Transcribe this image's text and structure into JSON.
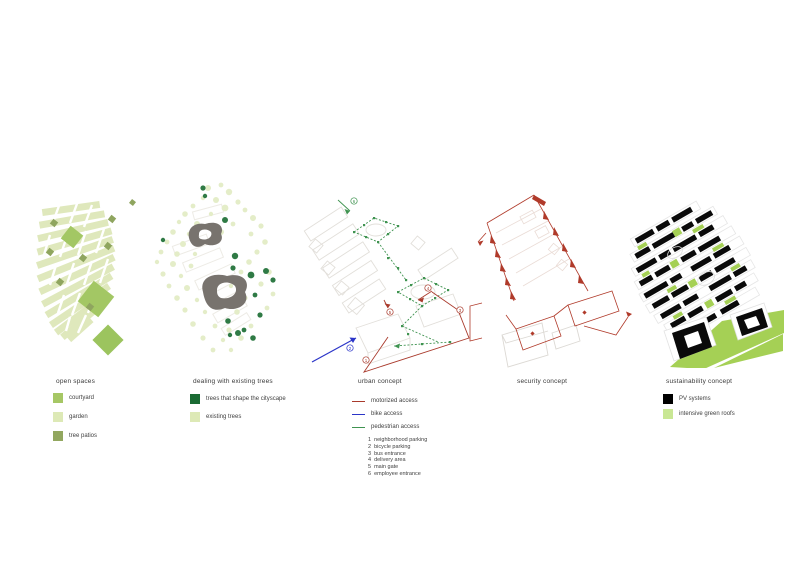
{
  "sheet": {
    "background": "#ffffff"
  },
  "colors": {
    "pale_green": "#dde9b6",
    "courtyard_green": "#a6c765",
    "tree_patio_olive": "#92a75f",
    "dark_tree_green": "#1a6b33",
    "motorized_red": "#a93a2c",
    "bike_blue": "#2b35c8",
    "pedestrian_green": "#3f9350",
    "pv_black": "#000000",
    "green_roof": "#c9e794",
    "vivid_roof_green": "#a5d055",
    "blob_grey": "#78736e"
  },
  "panels": [
    {
      "id": "open-spaces",
      "title": "open spaces",
      "legend": [
        {
          "label": "courtyard",
          "color": "#a6c765"
        },
        {
          "label": "garden",
          "color": "#dde9b6"
        },
        {
          "label": "tree patios",
          "color": "#92a75f"
        }
      ]
    },
    {
      "id": "existing-trees",
      "title": "dealing with existing trees",
      "legend": [
        {
          "label": "trees that shape the cityscape",
          "color": "#1a6b33"
        },
        {
          "label": "existing trees",
          "color": "#dde9b6"
        }
      ]
    },
    {
      "id": "urban-concept",
      "title": "urban concept",
      "legend_lines": [
        {
          "label": "motorized access",
          "color": "#a93a2c"
        },
        {
          "label": "bike access",
          "color": "#2b35c8"
        },
        {
          "label": "pedestrian access",
          "color": "#3f9350"
        }
      ],
      "numbered_items": [
        {
          "num": "1",
          "label": "neighborhood parking"
        },
        {
          "num": "2",
          "label": "bicycle parking"
        },
        {
          "num": "3",
          "label": "bus entrance"
        },
        {
          "num": "4",
          "label": "delivery area"
        },
        {
          "num": "5",
          "label": "main gate"
        },
        {
          "num": "6",
          "label": "employee entrance"
        }
      ]
    },
    {
      "id": "security-concept",
      "title": "security concept"
    },
    {
      "id": "sustainability-concept",
      "title": "sustainability concept",
      "legend": [
        {
          "label": "PV systems",
          "color": "#000000"
        },
        {
          "label": "intensive green roofs",
          "color": "#c9e794"
        }
      ]
    }
  ]
}
